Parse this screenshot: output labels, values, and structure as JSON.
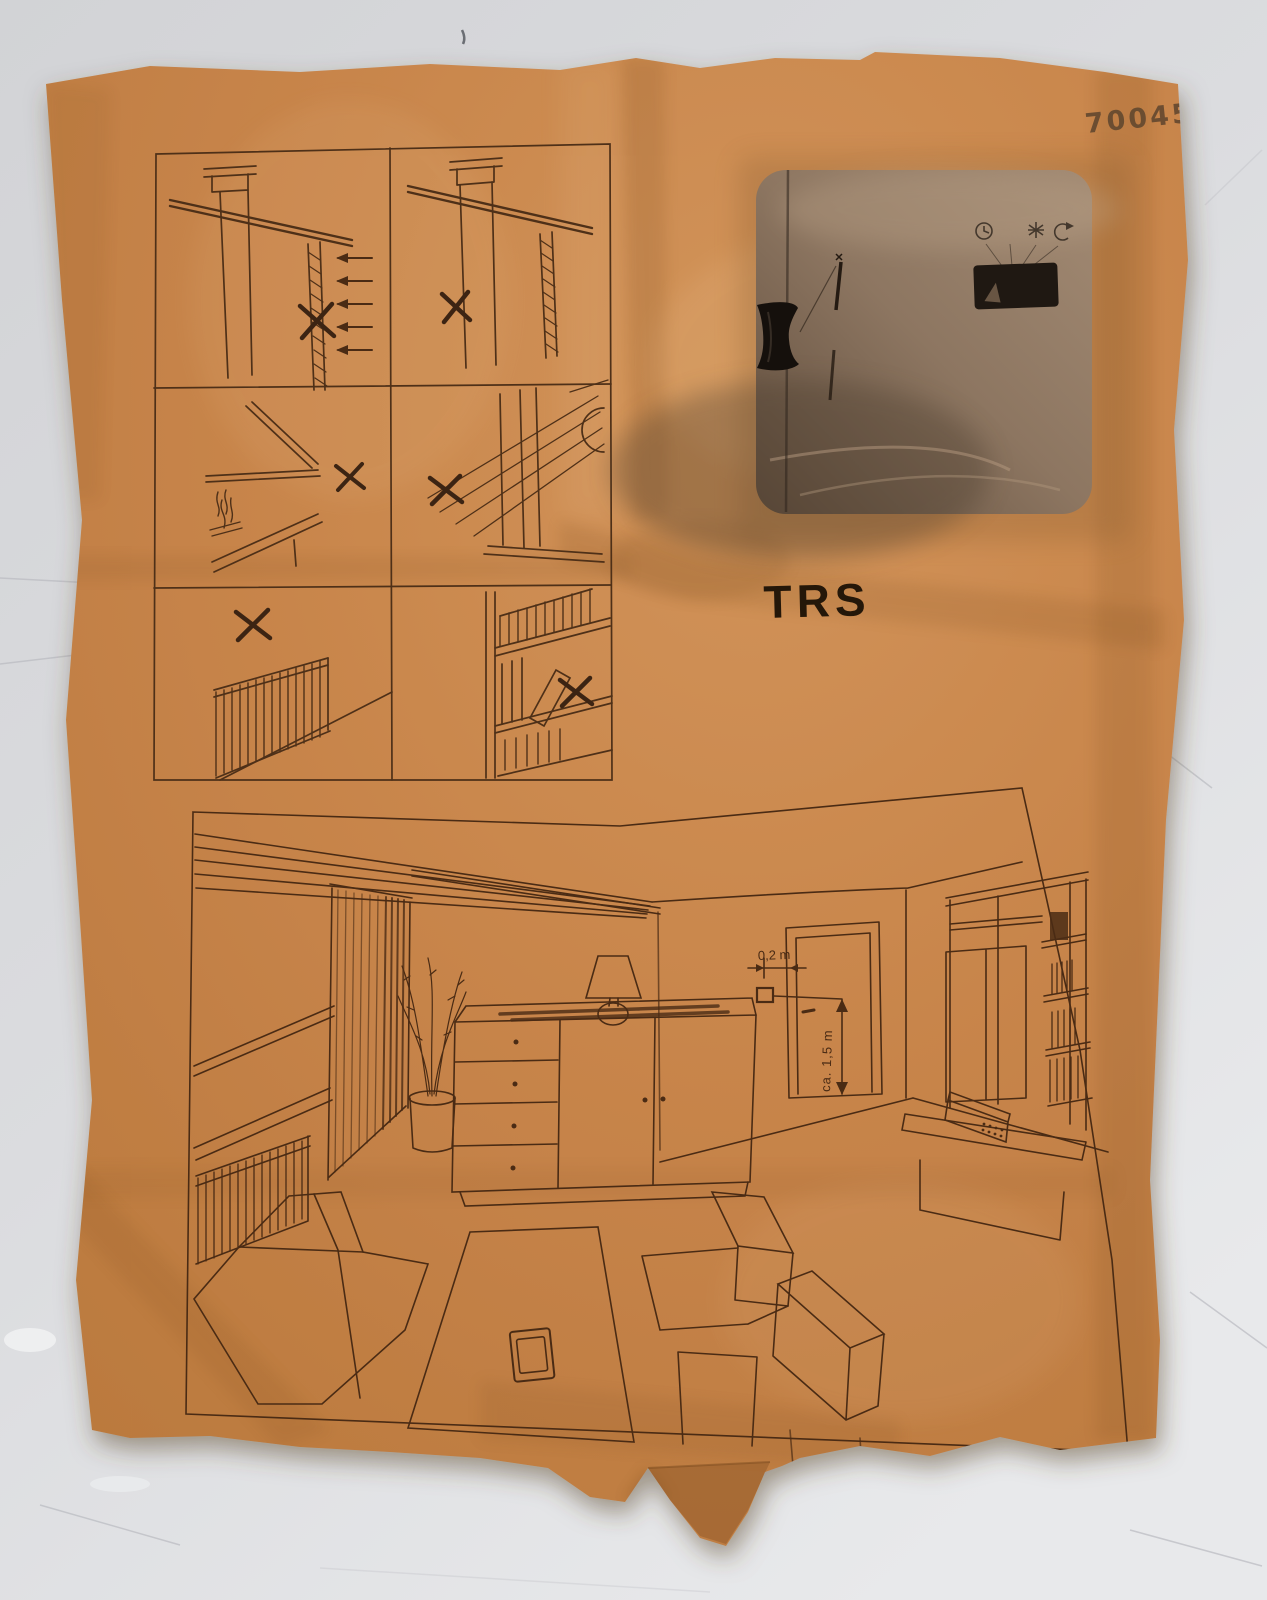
{
  "scene": {
    "description_colors": {
      "surface": "#d7d8da",
      "paper": "#c8854b",
      "paper_shadow": "#5a4526",
      "ink": "#4a2b14",
      "stamp_ink": "#63482f",
      "device_body": "#8d7661",
      "device_knob": "#15100c",
      "switch": "#1f1812"
    }
  },
  "stamp": {
    "number": "70045"
  },
  "device_photo": {
    "model_label": "TRS",
    "icons": [
      "clock-icon",
      "moon-icon",
      "sun-icon",
      "override-icon"
    ],
    "parts": [
      "slider-knob",
      "slider-track",
      "mode-switch"
    ]
  },
  "warning_panels": [
    {
      "name": "no-exterior-wall-draft",
      "icon": "x-mark"
    },
    {
      "name": "no-chimney-wall",
      "icon": "x-mark"
    },
    {
      "name": "no-above-fireplace",
      "icon": "x-mark"
    },
    {
      "name": "no-direct-sunlight-window",
      "icon": "x-mark"
    },
    {
      "name": "no-above-radiator",
      "icon": "x-mark"
    },
    {
      "name": "no-enclosed-bookshelf",
      "icon": "x-mark"
    }
  ],
  "room_diagram": {
    "labels": {
      "thermostat_offset": "0,2 m",
      "mounting_height": "ca. 1,5 m"
    },
    "furniture": [
      "curtain",
      "plant",
      "sideboard",
      "table-lamp",
      "door",
      "radiator",
      "bench",
      "coffee-table",
      "armchair",
      "wall-unit",
      "hifi"
    ]
  }
}
